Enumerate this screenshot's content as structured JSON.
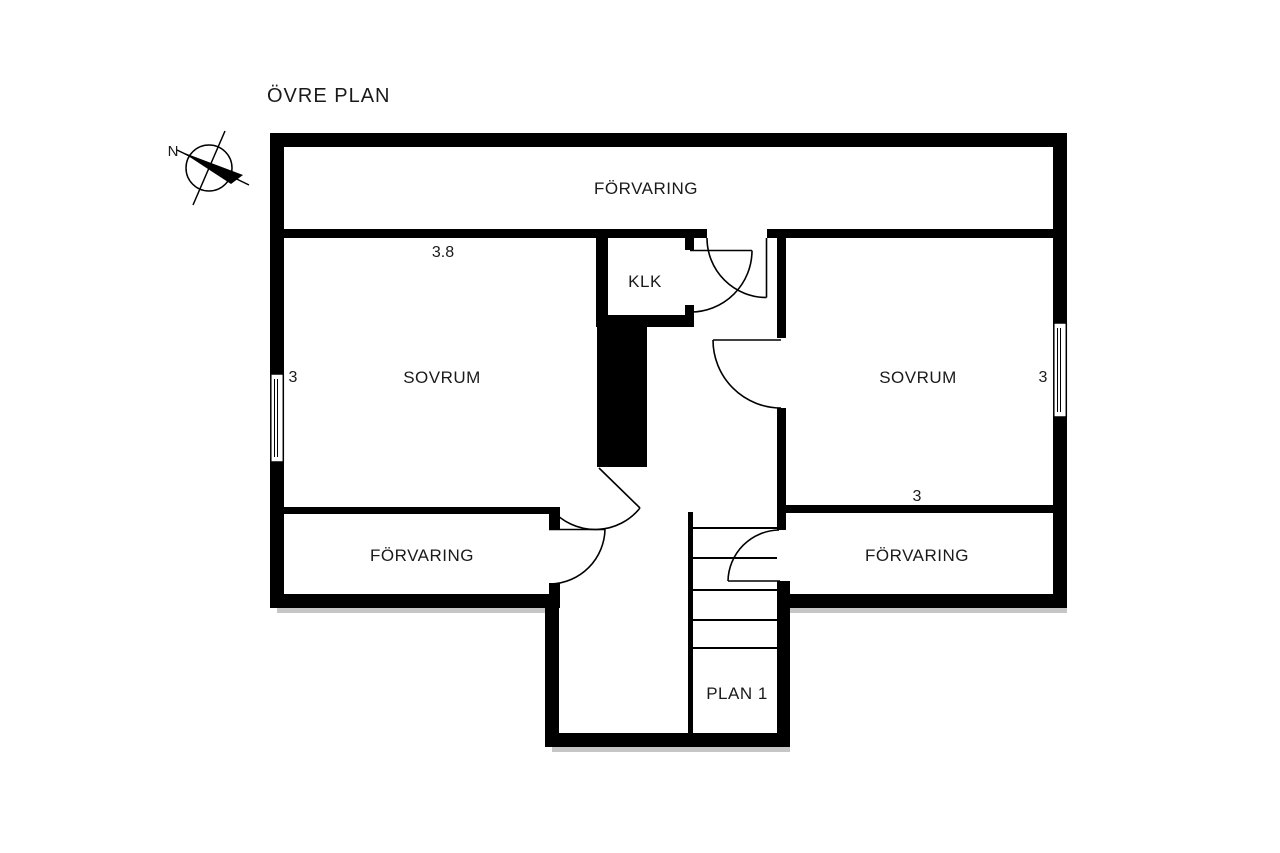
{
  "title": "ÖVRE PLAN",
  "compass": {
    "north_label": "N"
  },
  "rooms": {
    "storage_top": "FÖRVARING",
    "closet": "KLK",
    "bedroom_left": "SOVRUM",
    "bedroom_right": "SOVRUM",
    "storage_bottom_left": "FÖRVARING",
    "storage_bottom_right": "FÖRVARING",
    "stair_landing": "PLAN 1"
  },
  "dimensions": {
    "bedroom_left_width": "3.8",
    "bedroom_left_depth": "3",
    "bedroom_right_depth": "3",
    "bedroom_right_width": "3"
  },
  "colors": {
    "walls": "#000000",
    "background": "#ffffff",
    "text": "#1a1a1a"
  }
}
